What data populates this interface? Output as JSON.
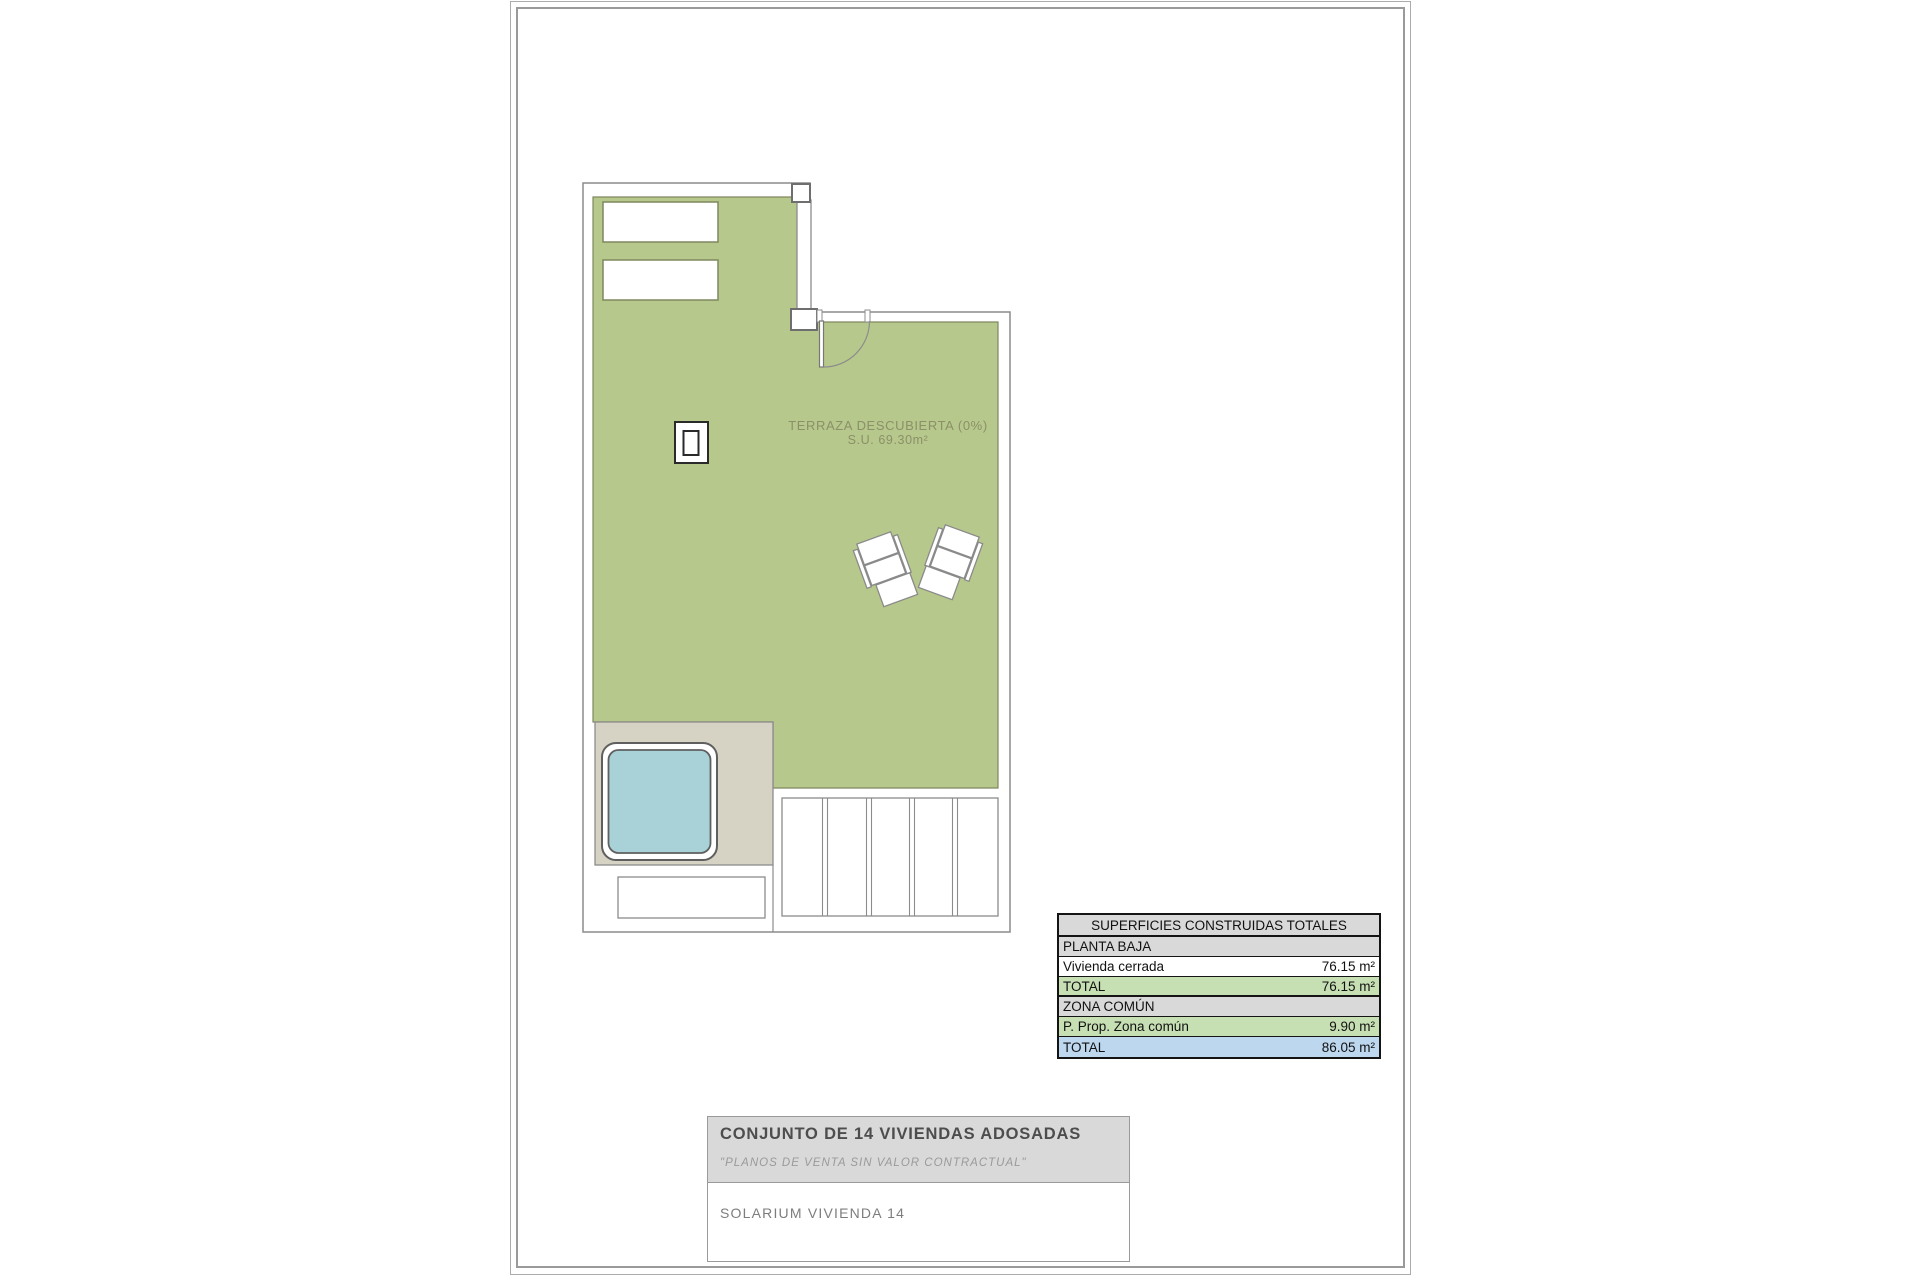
{
  "plan": {
    "terrace_label_line1": "TERRAZA DESCUBIERTA (0%)",
    "terrace_label_line2": "S.U. 69.30m²"
  },
  "areas_table": {
    "title": "SUPERFICIES CONSTRUIDAS TOTALES",
    "rows": [
      {
        "label": "PLANTA BAJA",
        "value": ""
      },
      {
        "label": "Vivienda cerrada",
        "value": "76.15 m²"
      },
      {
        "label": "TOTAL",
        "value": "76.15 m²"
      },
      {
        "label": "ZONA COMÚN",
        "value": ""
      },
      {
        "label": "P. Prop. Zona común",
        "value": "9.90 m²"
      },
      {
        "label": "TOTAL",
        "value": "86.05 m²"
      }
    ]
  },
  "title_block": {
    "project": "CONJUNTO DE 14 VIVIENDAS ADOSADAS",
    "disclaimer": "\"PLANOS DE VENTA SIN VALOR CONTRACTUAL\"",
    "sheet": "SOLARIUM VIVIENDA 14"
  },
  "colors": {
    "terrace_green": "#b6c88c",
    "terrace_edge": "#7f885f",
    "pool_water": "#a9d2d8",
    "deck_beige": "#d6d2c4",
    "wall_gray": "#8c8c8c",
    "label_olive": "#8b9068",
    "table_section_gray": "#d9d9d9",
    "table_green": "#c6e0b4",
    "table_blue": "#bdd7ee"
  }
}
